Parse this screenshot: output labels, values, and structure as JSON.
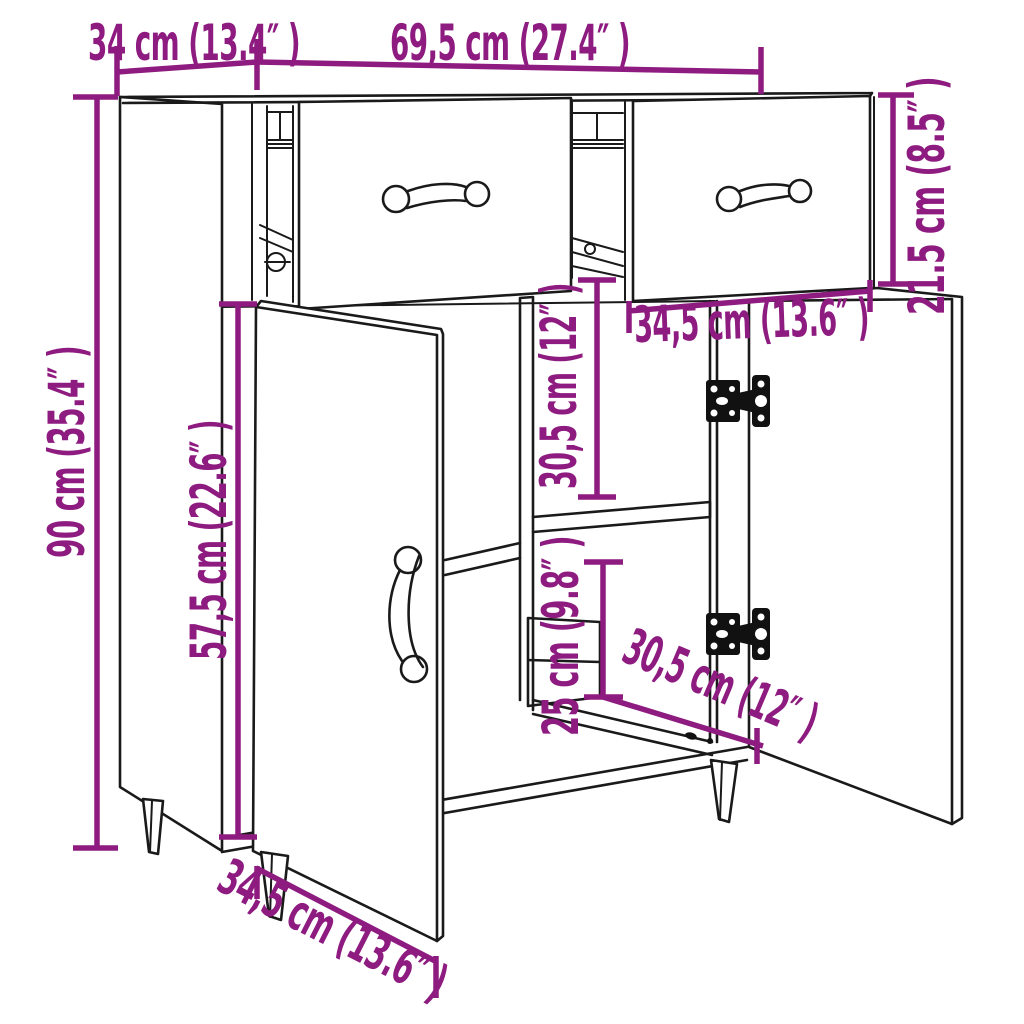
{
  "diagram": {
    "subject": "sideboard-dimension-diagram",
    "background_color": "#ffffff",
    "accent_color": "#8e1b80",
    "outline_color": "#1a1a1a",
    "labels": {
      "depth": "34 cm (13.4″ )",
      "width": "69,5 cm (27.4″ )",
      "height": "90 cm (35.4″ )",
      "door_height": "57,5 cm (22.6″ )",
      "drawer_height": "21.5 cm (8.5″ )",
      "drawer_width": "34,5 cm (13.6″ )",
      "upper_compartment_height": "30,5 cm (12″ )",
      "lower_compartment_height": "25 cm (9.8″ )",
      "compartment_depth": "30,5 cm (12″ )",
      "door_width": "34,5 cm (13.6″ )"
    }
  }
}
